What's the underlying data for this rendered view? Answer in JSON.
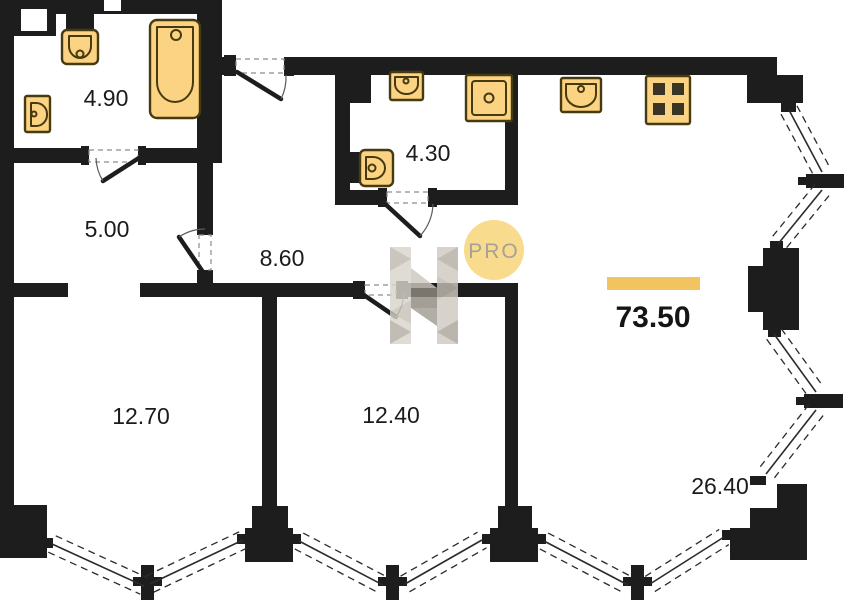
{
  "watermark": {
    "badge_text": "PRO"
  },
  "total_area": "73.50",
  "rooms": [
    {
      "id": "bathroom-top-left",
      "area": "4.90"
    },
    {
      "id": "hall",
      "area": "5.00"
    },
    {
      "id": "corridor",
      "area": "8.60"
    },
    {
      "id": "bathroom-top-middle",
      "area": "4.30"
    },
    {
      "id": "room-bottom-left",
      "area": "12.70"
    },
    {
      "id": "room-bottom-middle",
      "area": "12.40"
    },
    {
      "id": "living-kitchen",
      "area": "26.40"
    }
  ],
  "colors": {
    "wall": "#1d1d1d",
    "fixture_fill": "#fbd382",
    "fixture_stroke": "#463a10",
    "accent_bar": "#f2c45f",
    "badge_fill": "#f8db8c",
    "badge_text": "#a6a198",
    "watermark_gray": "#9b968d"
  },
  "plan": {
    "windows": [
      {
        "x1": 52,
        "y1": 544,
        "x2": 144,
        "y2": 586
      },
      {
        "x1": 150,
        "y1": 584,
        "x2": 243,
        "y2": 540
      },
      {
        "x1": 299,
        "y1": 541,
        "x2": 383,
        "y2": 585
      },
      {
        "x1": 405,
        "y1": 584,
        "x2": 482,
        "y2": 540
      },
      {
        "x1": 544,
        "y1": 541,
        "x2": 628,
        "y2": 585
      },
      {
        "x1": 650,
        "y1": 584,
        "x2": 724,
        "y2": 537
      },
      {
        "x1": 789,
        "y1": 110,
        "x2": 822,
        "y2": 172
      },
      {
        "x1": 822,
        "y1": 190,
        "x2": 778,
        "y2": 244
      },
      {
        "x1": 774,
        "y1": 334,
        "x2": 816,
        "y2": 392
      },
      {
        "x1": 816,
        "y1": 410,
        "x2": 766,
        "y2": 474
      }
    ]
  }
}
